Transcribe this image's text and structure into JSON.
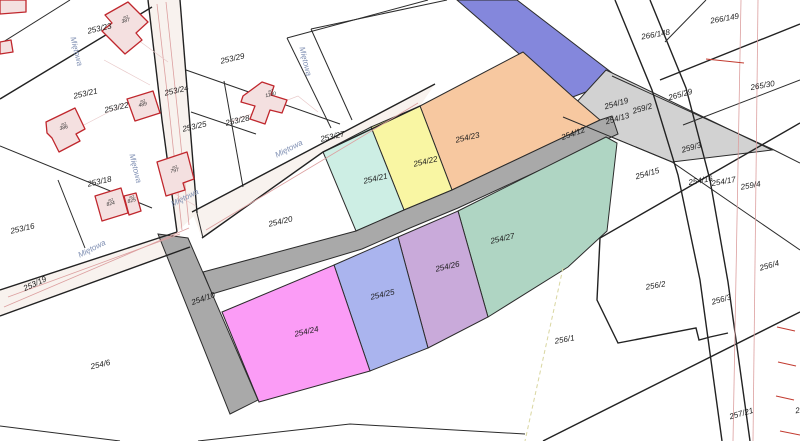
{
  "map": {
    "title": "cadastral-parcel-map",
    "street_name": "Miętowa",
    "building_annotation": "m2",
    "parcel_labels": [
      {
        "text": "253/23",
        "x": 100,
        "y": 31,
        "rot": -13
      },
      {
        "text": "253/29",
        "x": 233,
        "y": 61,
        "rot": -13
      },
      {
        "text": "253/21",
        "x": 86,
        "y": 96,
        "rot": -13
      },
      {
        "text": "253/24",
        "x": 177,
        "y": 93,
        "rot": -13
      },
      {
        "text": "253/22",
        "x": 117,
        "y": 110,
        "rot": -13
      },
      {
        "text": "253/25",
        "x": 195,
        "y": 129,
        "rot": -13
      },
      {
        "text": "253/28",
        "x": 238,
        "y": 123,
        "rot": -13
      },
      {
        "text": "253/27",
        "x": 333,
        "y": 139,
        "rot": -13
      },
      {
        "text": "253/18",
        "x": 100,
        "y": 184,
        "rot": -13
      },
      {
        "text": "253/16",
        "x": 23,
        "y": 231,
        "rot": -13
      },
      {
        "text": "253/19",
        "x": 36,
        "y": 286,
        "rot": -25
      },
      {
        "text": "254/20",
        "x": 281,
        "y": 224,
        "rot": -13
      },
      {
        "text": "254/6",
        "x": 101,
        "y": 367,
        "rot": -13
      },
      {
        "text": "254/10",
        "x": 204,
        "y": 301,
        "rot": -20,
        "color": "#595959"
      },
      {
        "text": "254/21",
        "x": 376,
        "y": 181,
        "rot": -13
      },
      {
        "text": "254/22",
        "x": 426,
        "y": 164,
        "rot": -13
      },
      {
        "text": "254/23",
        "x": 468,
        "y": 140,
        "rot": -13
      },
      {
        "text": "254/24",
        "x": 307,
        "y": 334,
        "rot": -13
      },
      {
        "text": "254/25",
        "x": 383,
        "y": 297,
        "rot": -13
      },
      {
        "text": "254/26",
        "x": 448,
        "y": 269,
        "rot": -13
      },
      {
        "text": "254/27",
        "x": 503,
        "y": 241,
        "rot": -13
      },
      {
        "text": "254/12",
        "x": 574,
        "y": 136,
        "rot": -20,
        "color": "#4a4a4a"
      },
      {
        "text": "254/19",
        "x": 617,
        "y": 106,
        "rot": -16
      },
      {
        "text": "254/13",
        "x": 618,
        "y": 121,
        "rot": -16
      },
      {
        "text": "259/2",
        "x": 643,
        "y": 111,
        "rot": -16
      },
      {
        "text": "265/29",
        "x": 681,
        "y": 97,
        "rot": -16
      },
      {
        "text": "266/148",
        "x": 656,
        "y": 37,
        "rot": -10
      },
      {
        "text": "266/149",
        "x": 725,
        "y": 21,
        "rot": -10
      },
      {
        "text": "265/30",
        "x": 763,
        "y": 88,
        "rot": -10
      },
      {
        "text": "259/3",
        "x": 692,
        "y": 150,
        "rot": -16
      },
      {
        "text": "254/16",
        "x": 701,
        "y": 183,
        "rot": -10
      },
      {
        "text": "254/17",
        "x": 724,
        "y": 184,
        "rot": -10
      },
      {
        "text": "259/4",
        "x": 751,
        "y": 188,
        "rot": -10
      },
      {
        "text": "254/15",
        "x": 648,
        "y": 176,
        "rot": -16
      },
      {
        "text": "256/2",
        "x": 656,
        "y": 288,
        "rot": -10
      },
      {
        "text": "256/3",
        "x": 722,
        "y": 302,
        "rot": -16
      },
      {
        "text": "256/4",
        "x": 770,
        "y": 268,
        "rot": -16
      },
      {
        "text": "256/1",
        "x": 565,
        "y": 342,
        "rot": -10
      },
      {
        "text": "257/21",
        "x": 742,
        "y": 416,
        "rot": -16
      },
      {
        "text": "2",
        "x": 798,
        "y": 413,
        "rot": -10
      }
    ],
    "street_labels": [
      {
        "x": 74,
        "y": 52,
        "rot": 76
      },
      {
        "x": 303,
        "y": 62,
        "rot": 76
      },
      {
        "x": 133,
        "y": 169,
        "rot": 76
      },
      {
        "x": 186,
        "y": 200,
        "rot": -27
      },
      {
        "x": 93,
        "y": 251,
        "rot": -27
      },
      {
        "x": 290,
        "y": 151,
        "rot": -27
      }
    ],
    "building_labels": [
      {
        "text": "387",
        "x": 126,
        "y": 22
      },
      {
        "text": "386",
        "x": 64,
        "y": 129
      },
      {
        "text": "489",
        "x": 143,
        "y": 106
      },
      {
        "text": "797",
        "x": 175,
        "y": 172
      },
      {
        "text": "1190",
        "x": 271,
        "y": 96,
        "size": 6.5
      },
      {
        "text": "824",
        "x": 111,
        "y": 205
      },
      {
        "text": "825",
        "x": 132,
        "y": 202,
        "size": 4.5
      }
    ],
    "colors": {
      "road_fill": "#a9a9a9",
      "road_259_2": "#d2d2d2",
      "street_tint": "#f8f2ee",
      "blue_road": "#8487dc",
      "254/23": "#f7c8a0",
      "254/22": "#f9f6a3",
      "254/21": "#cdeee4",
      "254/27": "#afd5c3",
      "254/26": "#c9aada",
      "254/25": "#aab4ee",
      "254/24": "#fb9cf6",
      "building_fill": "#f4e0e0",
      "building_stroke": "#c0272d",
      "boundary": "#2b2b2b",
      "street_label": "#7e8eb2",
      "utility_pink": "#dc9f9f",
      "tick_red": "#c23b30",
      "dashed_yellow": "#d9d6a0"
    }
  }
}
